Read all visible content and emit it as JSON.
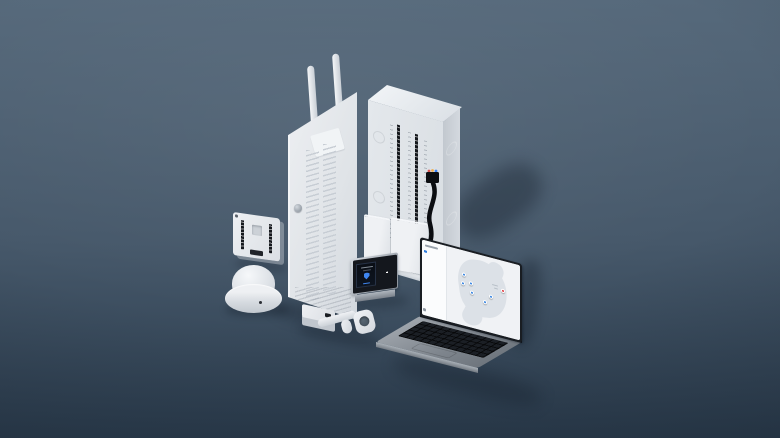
{
  "scene": {
    "description": "isometric product render of a security system kit on a blue-gray backdrop",
    "devices": [
      "enclosure-cabinet",
      "enclosure-door-with-antennas",
      "io-expansion-module",
      "dome-sounder",
      "contact-sensor-set",
      "alarm-keypad",
      "laptop-with-security-dashboard"
    ]
  },
  "palette": {
    "background_top": "#56697b",
    "background_bottom": "#2c3d4e",
    "device_white": "#e9ebee",
    "laptop_silver": "#8d949c",
    "screen_dark": "#14171d",
    "accent_blue": "#2f7fe0",
    "alert_red": "#e0383e"
  },
  "keypad": {
    "display_icon": "shield-icon",
    "accent": "#3f86f0",
    "key_rows": 4,
    "key_cols": 3
  },
  "laptop_screen": {
    "sidebar": {
      "rows": [
        {
          "dot": "#2f7fe0",
          "line_width_pct": 72
        },
        {
          "dot": "#2f7fe0",
          "line_width_pct": 64
        },
        {
          "dot": "#2f7fe0",
          "line_width_pct": 70
        },
        {
          "dot": "#e0383e",
          "line_width_pct": 58
        },
        {
          "dot": "#2f7fe0",
          "line_width_pct": 66
        },
        {
          "dot": "#2f7fe0",
          "line_width_pct": 74
        },
        {
          "dot": "#2f7fe0",
          "line_width_pct": 60
        },
        {
          "dot": "#2f7fe0",
          "line_width_pct": 68
        },
        {
          "dot": "#2f7fe0",
          "line_width_pct": 62
        },
        {
          "dot": "#2f7fe0",
          "line_width_pct": 56
        }
      ]
    },
    "map": {
      "region": "north-america",
      "pins": [
        {
          "x": 42.8,
          "y": 32.4,
          "color": "#2f7fe0"
        },
        {
          "x": 50.3,
          "y": 41.6,
          "color": "#2f7fe0"
        },
        {
          "x": 41.9,
          "y": 44.6,
          "color": "#2f7fe0"
        },
        {
          "x": 50.7,
          "y": 53.7,
          "color": "#2f7fe0"
        },
        {
          "x": 69.9,
          "y": 51.4,
          "color": "#2f7fe0"
        },
        {
          "x": 64.0,
          "y": 61.4,
          "color": "#2f7fe0"
        },
        {
          "x": 82.4,
          "y": 39.5,
          "color": "#e0383e"
        }
      ]
    }
  }
}
